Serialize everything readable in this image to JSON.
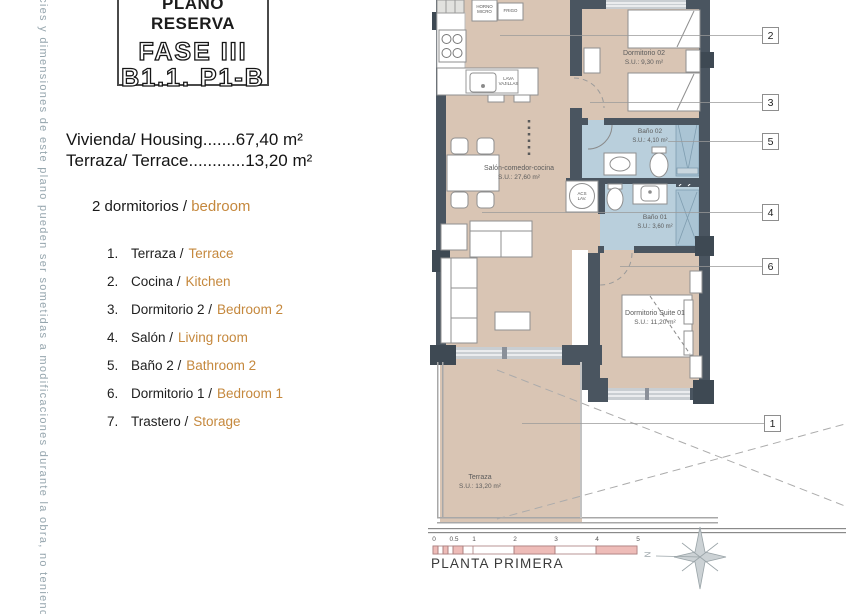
{
  "side_note": "rficies y dimensiones de este plano pueden ser sometidas a modificaciones durante la obra, no teniendo",
  "title_block": {
    "reserve": "PLANO RESERVA",
    "phase": "FASE III",
    "unit": "B1.1. P1-B"
  },
  "summary": {
    "housing_line": "Vivienda/ Housing.......67,40 m²",
    "terrace_line": "Terraza/ Terrace............13,20 m²",
    "bedrooms_es": "2 dormitorios /",
    "bedrooms_en": "bedroom"
  },
  "legend": [
    {
      "num": "1.",
      "es": "Terraza /",
      "en": "Terrace"
    },
    {
      "num": "2.",
      "es": "Cocina /",
      "en": "Kitchen"
    },
    {
      "num": "3.",
      "es": "Dormitorio 2 /",
      "en": "Bedroom 2"
    },
    {
      "num": "4.",
      "es": "Salón /",
      "en": "Living room"
    },
    {
      "num": "5.",
      "es": "Baño 2 /",
      "en": "Bathroom 2"
    },
    {
      "num": "6.",
      "es": "Dormitorio 1 /",
      "en": "Bedroom 1"
    },
    {
      "num": "7.",
      "es": "Trastero /",
      "en": "Storage"
    }
  ],
  "plan": {
    "rooms": {
      "living": {
        "name": "Salón-comedor-cocina",
        "area": "S.U.: 27,60 m²"
      },
      "bedroom2": {
        "name": "Dormitorio 02",
        "area": "S.U.: 9,30 m²"
      },
      "bath2": {
        "name": "Baño 02",
        "area": "S.U.: 4,10 m²"
      },
      "bath1": {
        "name": "Baño 01",
        "area": "S.U.: 3,60 m²"
      },
      "suite": {
        "name": "Dormitorio Suite 01",
        "area": "S.U.: 11,20 m²"
      },
      "terrace": {
        "name": "Terraza",
        "area": "S.U.: 13,20 m²"
      }
    },
    "labels": {
      "horno": "HORNO\nMICRO",
      "frigo": "FRIGO",
      "lavavajillas": "LAVA\nVAJILLAS",
      "acs": "ACS\nLAV."
    },
    "callouts": {
      "c1": "1",
      "c2": "2",
      "c3": "3",
      "c4": "4",
      "c5": "5",
      "c6": "6"
    },
    "north": "N"
  },
  "footer": {
    "caption": "PLANTA PRIMERA",
    "scale_ticks": [
      "0",
      "0.5",
      "1",
      "2",
      "3",
      "4",
      "5"
    ]
  },
  "colors": {
    "floor_tan": "#d9c5b4",
    "bath_blue": "#b9cfdc",
    "shower_blue": "#aac4d4",
    "wall_dark": "#4a5560",
    "accent_orange": "#c5883d",
    "scale_pink": "#eebcb8",
    "side_note_gray": "#96a6ae"
  }
}
